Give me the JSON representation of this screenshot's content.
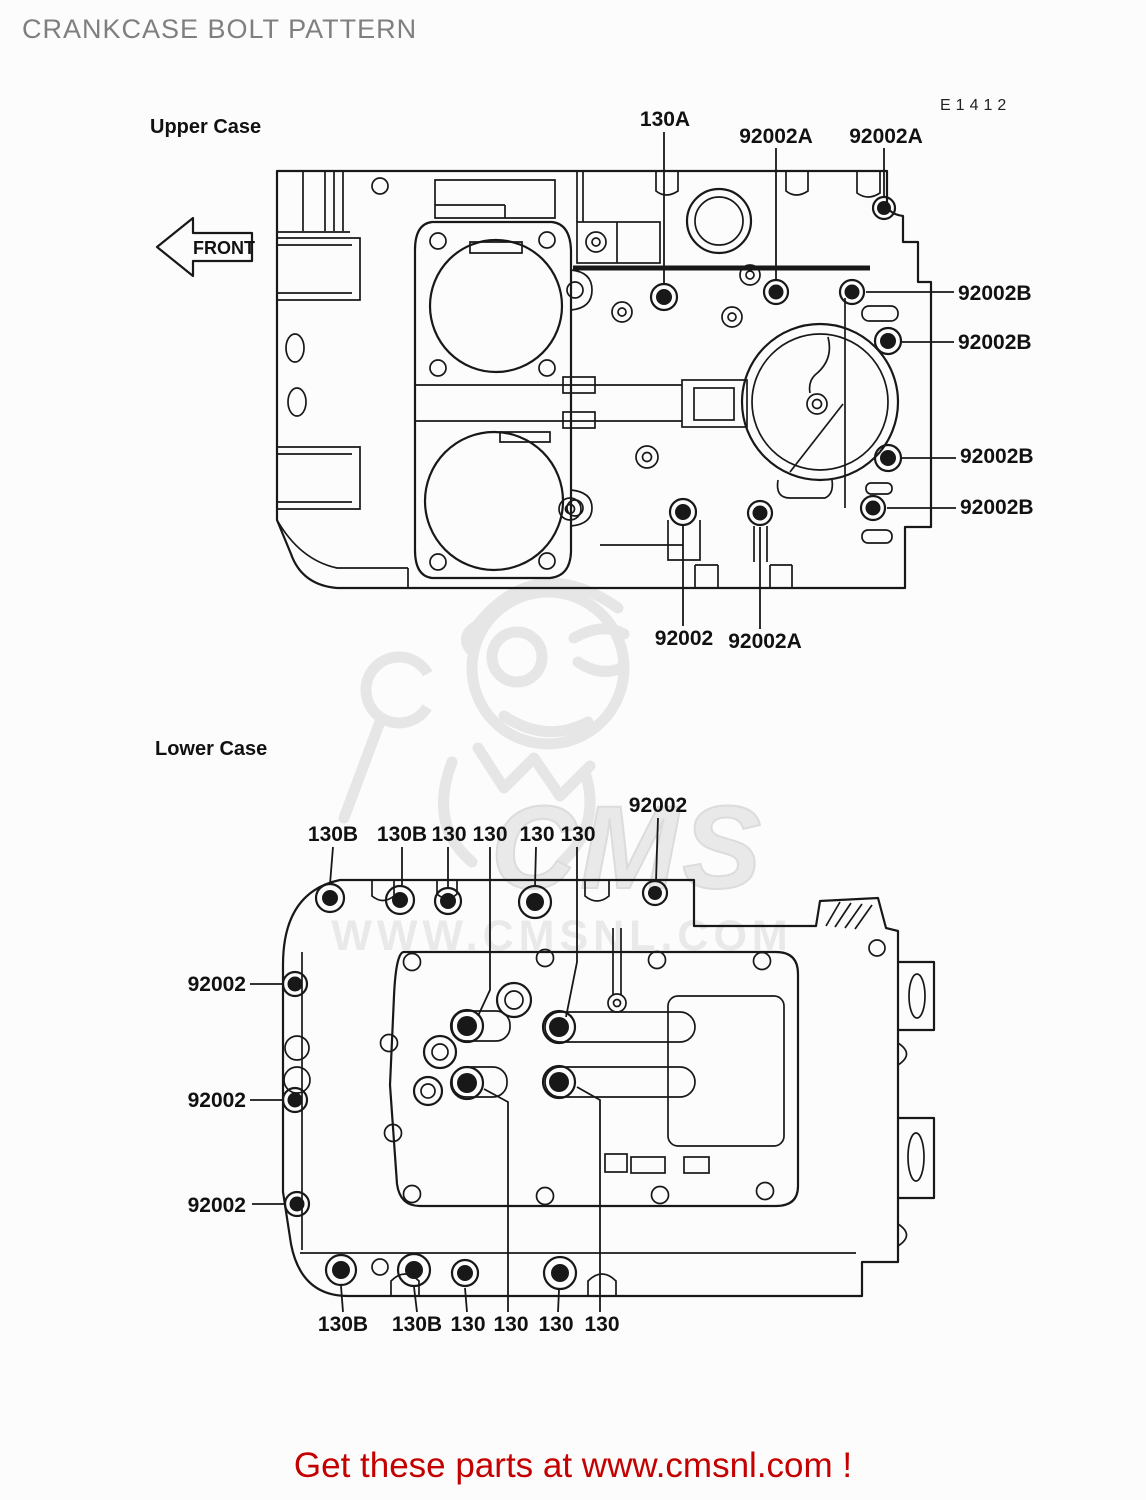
{
  "page": {
    "title": "CRANKCASE BOLT PATTERN",
    "diagram_code": "E1412",
    "footer_link": "Get these parts at www.cmsnl.com !"
  },
  "watermark": {
    "brand": "CMS",
    "url": "WWW.CMSNL.COM"
  },
  "upper_case": {
    "label": "Upper Case",
    "front_label": "FRONT",
    "callouts": {
      "top": [
        "130A",
        "92002A",
        "92002A"
      ],
      "right": [
        "92002B",
        "92002B",
        "92002B",
        "92002B"
      ],
      "bottom": [
        "92002",
        "92002A"
      ]
    }
  },
  "lower_case": {
    "label": "Lower Case",
    "callouts": {
      "top": [
        "130B",
        "130B",
        "130",
        "130",
        "130",
        "130"
      ],
      "top_right": "92002",
      "left": [
        "92002",
        "92002",
        "92002"
      ],
      "bottom": [
        "130B",
        "130B",
        "130",
        "130",
        "130",
        "130"
      ]
    }
  },
  "colors": {
    "accent_red": "#c40000",
    "title_gray": "#7f7f7f",
    "ink": "#181818"
  }
}
